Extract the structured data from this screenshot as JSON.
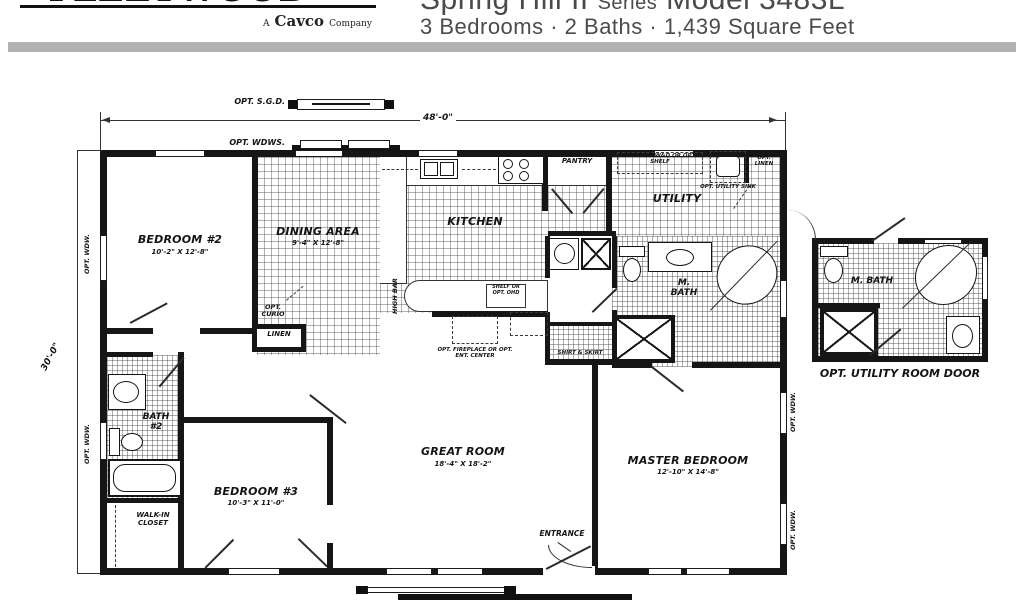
{
  "header": {
    "logo_main": "FLEETWOOD HOMES",
    "logo_sub_a": "A",
    "logo_sub_name": "Cavco",
    "logo_sub_co": "Company",
    "title_main": "Spring Hill II",
    "title_series": "Series",
    "title_model": "Model 3483L",
    "subtitle": "3 Bedrooms · 2 Baths · 1,439 Square Feet"
  },
  "dims": {
    "width": "48'-0\"",
    "depth": "30'-0\""
  },
  "rooms": {
    "bedroom2": {
      "name": "BEDROOM #2",
      "size": "10'-2\" X 12'-8\""
    },
    "dining": {
      "name": "DINING AREA",
      "size": "9'-4\" X 12'-8\""
    },
    "kitchen": {
      "name": "KITCHEN"
    },
    "pantry": {
      "name": "PANTRY"
    },
    "utility": {
      "name": "UTILITY"
    },
    "mbath": {
      "name": "M. BATH"
    },
    "bath2": {
      "name": "BATH #2"
    },
    "walkin": {
      "name": "WALK-IN CLOSET"
    },
    "bedroom3": {
      "name": "BEDROOM #3",
      "size": "10'-3\" X 11'-0\""
    },
    "great_room": {
      "name": "GREAT ROOM",
      "size": "18'-4\" X 18'-2\""
    },
    "master": {
      "name": "MASTER BEDROOM",
      "size": "12'-10\" X 14'-8\""
    }
  },
  "labels": {
    "opt_sgd": "OPT. S.G.D.",
    "opt_wdws": "OPT. WDWS.",
    "opt_wdw": "OPT. WDW.",
    "opt_curio": "OPT. CURIO",
    "linen": "LINEN",
    "high_bar": "HIGH BAR",
    "shelf_or_opt_ohd": "SHELF OR OPT. OHD",
    "book_case": "BOOK CASE",
    "opt_fireplace": "OPT. FIREPLACE OR OPT. ENT. CENTER",
    "opt_ohd_wd": "OPT. OHD W&D OR OPT. SHELF",
    "opt_utility_sink": "OPT. UTILITY SINK",
    "opt_linen": "OPT. LINEN",
    "shirt_skirt": "SHIRT & SKIRT",
    "entrance": "ENTRANCE",
    "opt_utility_room_door": "OPT. UTILITY ROOM DOOR"
  }
}
